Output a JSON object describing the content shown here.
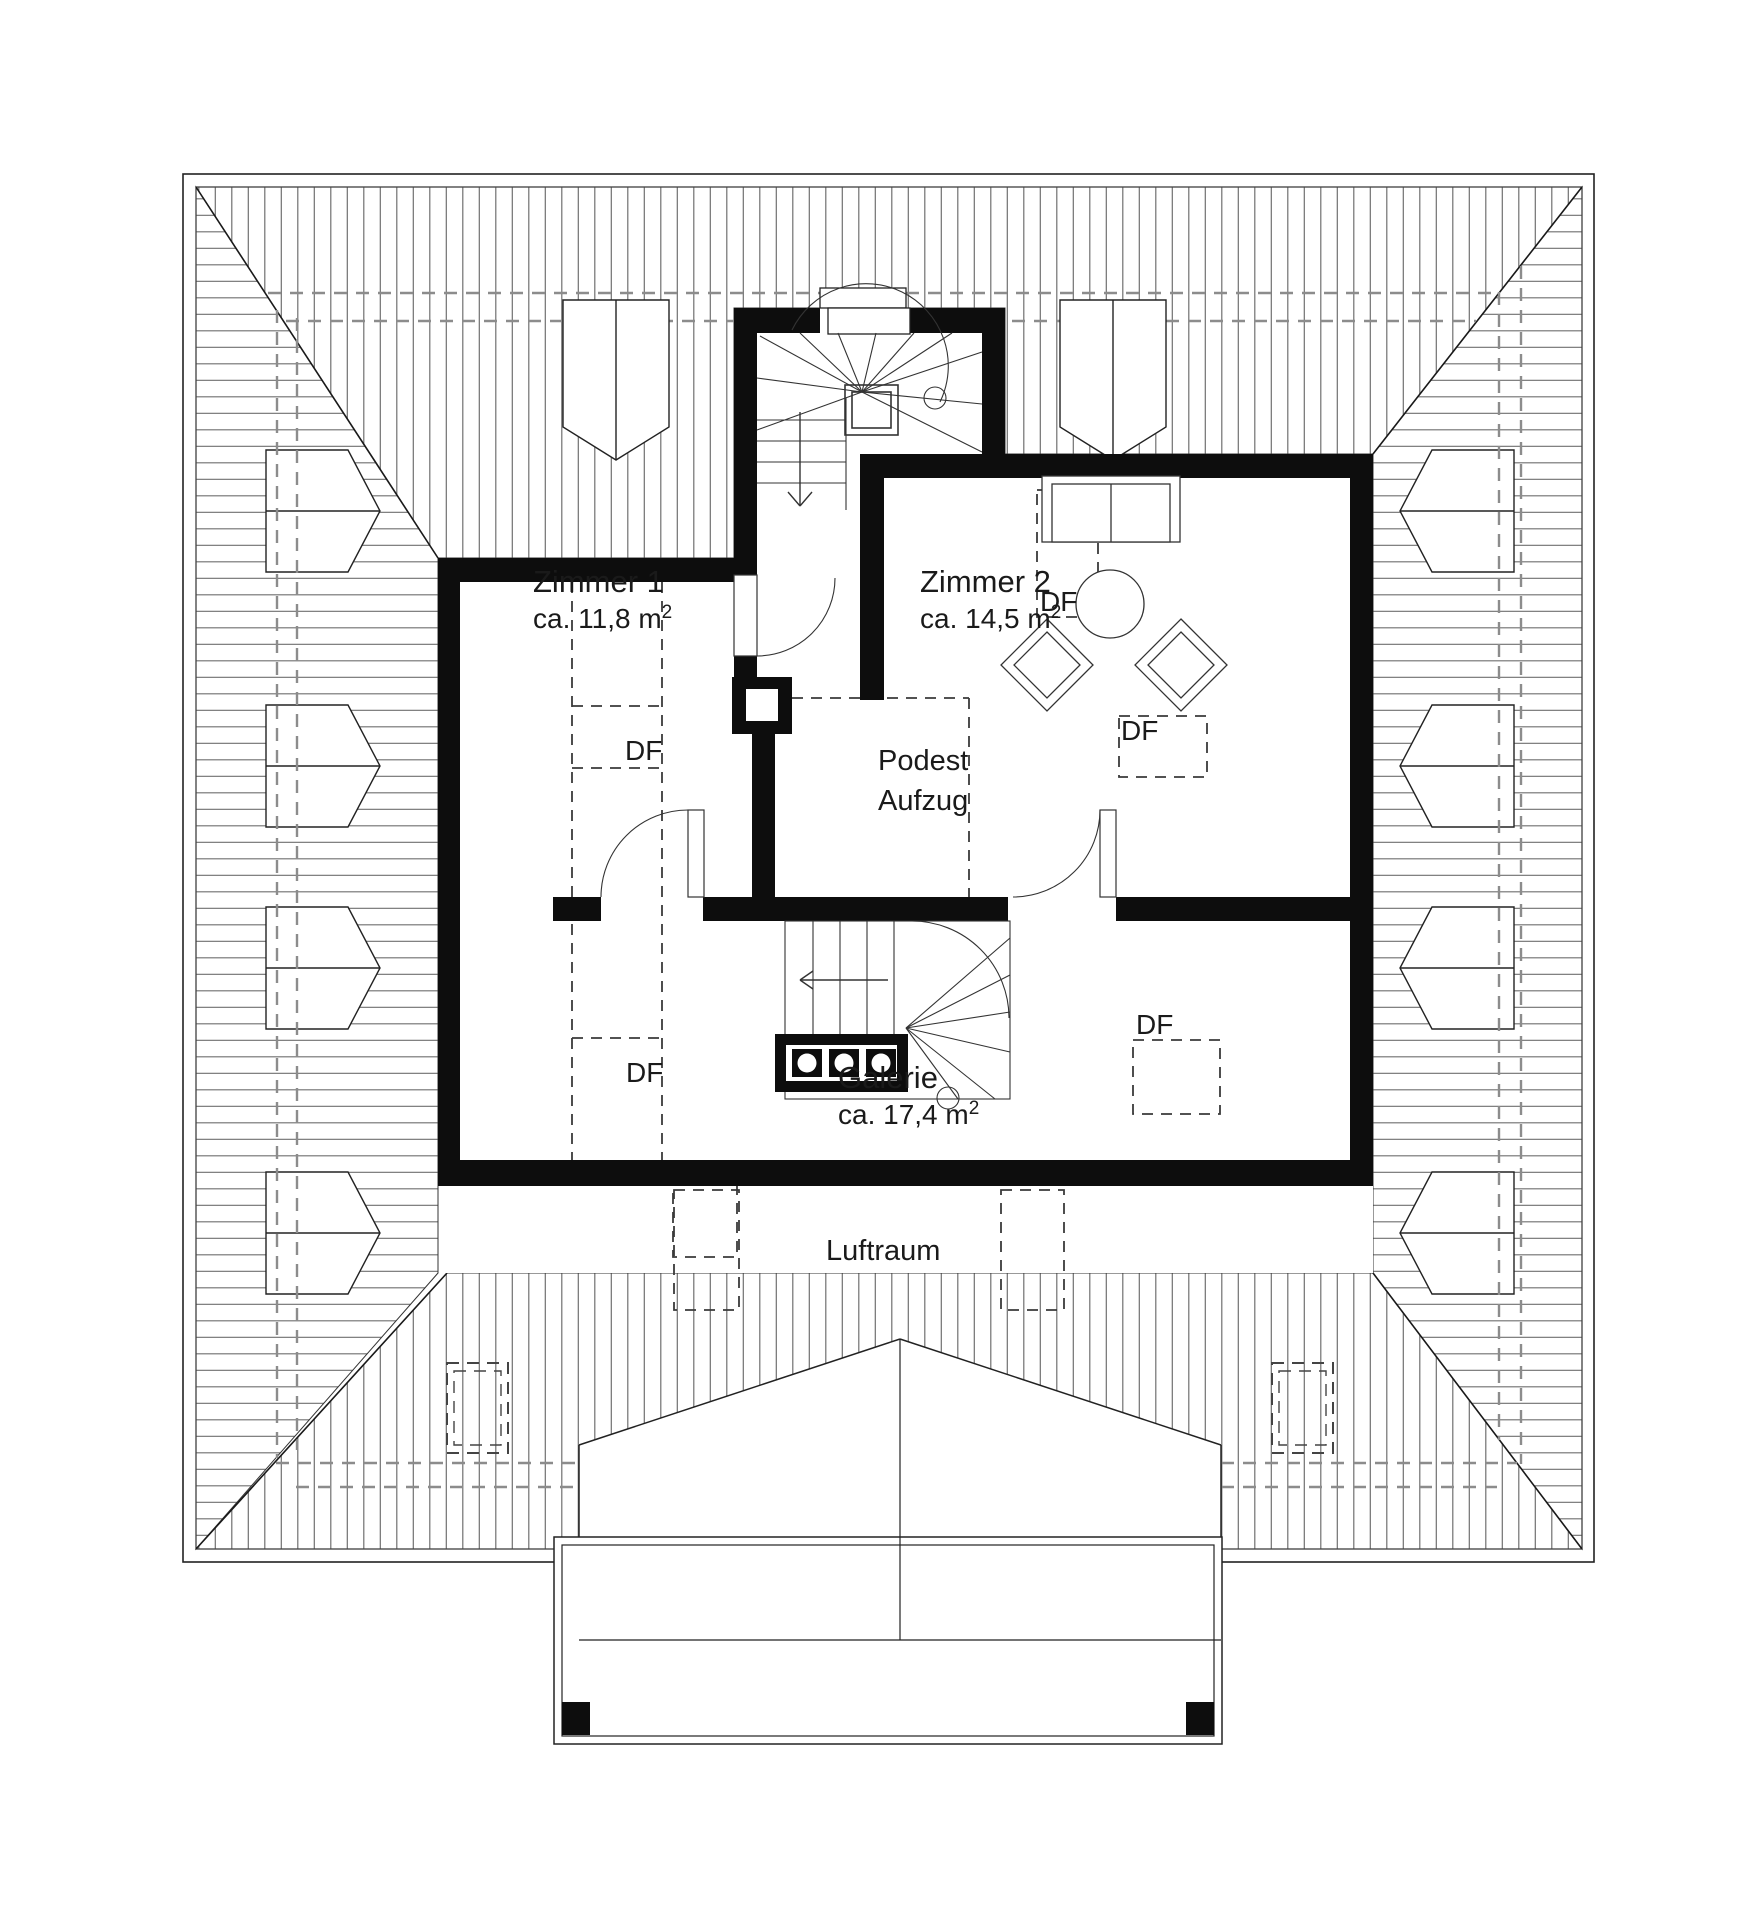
{
  "title": "Dachgeschoss Grundriss",
  "labels": {
    "zimmer1": {
      "name": "Zimmer 1",
      "area": "ca. 11,8 m",
      "sup": "2"
    },
    "zimmer2": {
      "name": "Zimmer 2",
      "area": "ca. 14,5 m",
      "sup": "2"
    },
    "galerie": {
      "name": "Galerie",
      "area": "ca. 17,4 m",
      "sup": "2"
    },
    "podest": {
      "line1": "Podest",
      "line2": "Aufzug"
    },
    "luftraum": "Luftraum",
    "df": "DF"
  },
  "rooms": [
    {
      "name": "Zimmer 1",
      "area_m2": "11,8"
    },
    {
      "name": "Zimmer 2",
      "area_m2": "14,5"
    },
    {
      "name": "Galerie",
      "area_m2": "17,4"
    },
    {
      "name": "Podest Aufzug"
    },
    {
      "name": "Luftraum"
    }
  ],
  "skylight_code": "DF",
  "skylight_count": 5,
  "colors": {
    "wall": "#0d0d0d",
    "hatch": "#6f6f6f",
    "eave_dash": "#8c8c8c",
    "line": "#222222"
  }
}
